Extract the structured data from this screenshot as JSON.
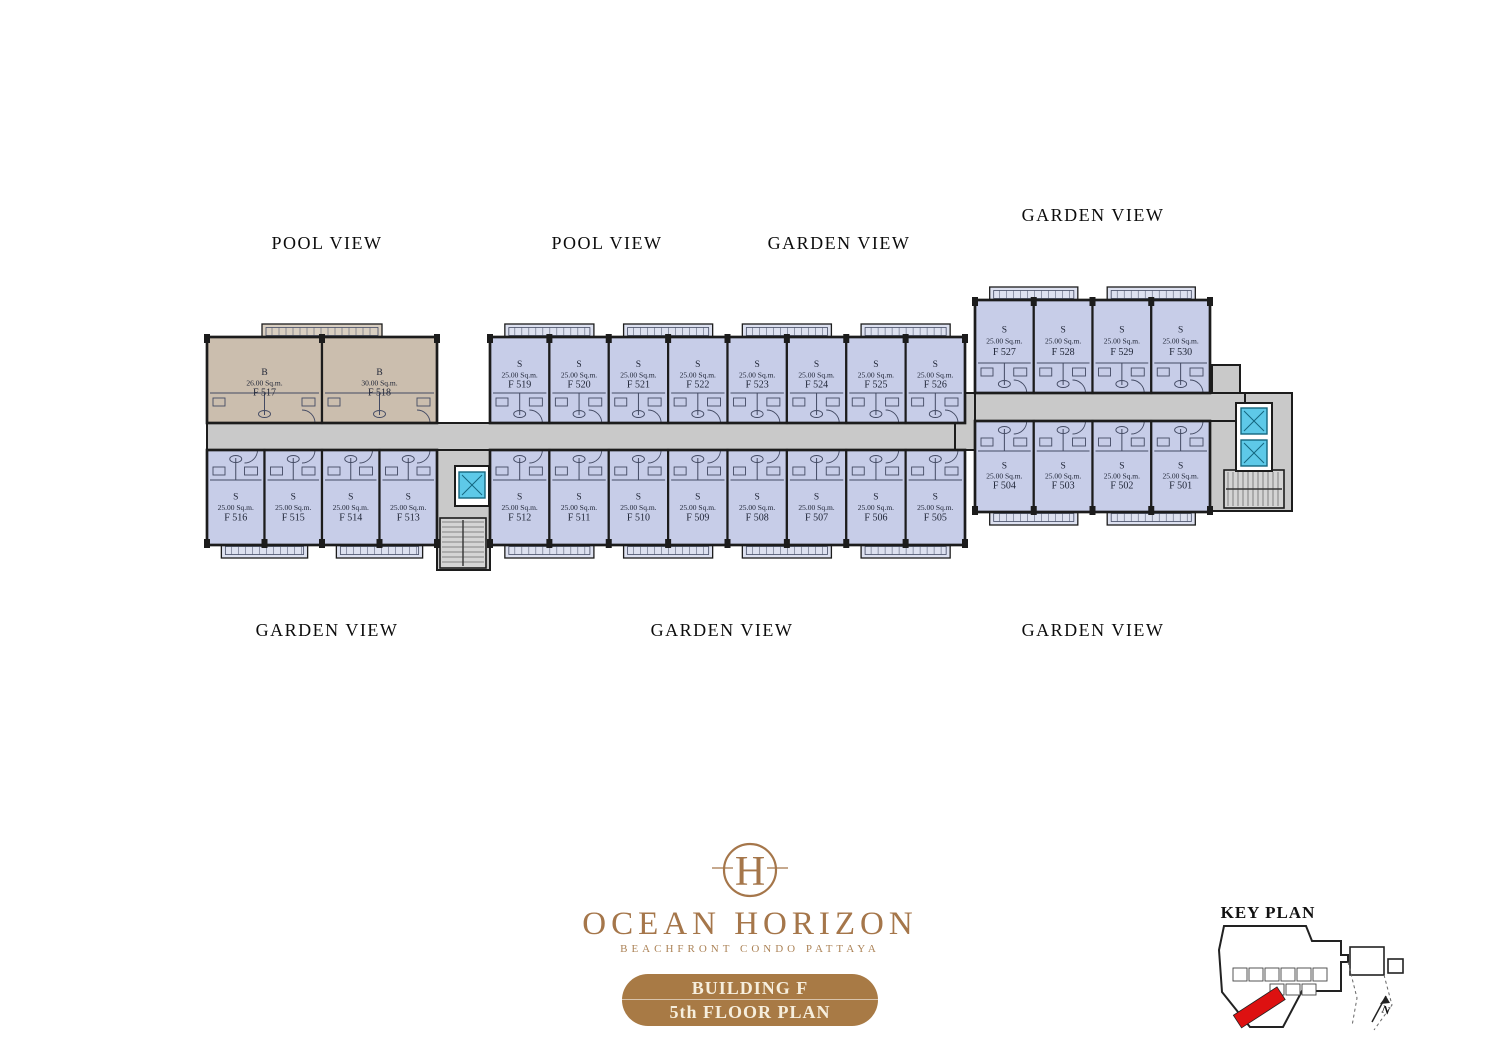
{
  "colors": {
    "unit_fill": "#c7cde8",
    "unit_fill_b": "#cbbeae",
    "wall": "#1c1c1c",
    "interior_line": "#434a63",
    "corridor_fill": "#c9c9c9",
    "balcony_fill": "#dde1f0",
    "balcony_fill_b": "#d9cfc1",
    "stair_fill": "#d4d4d4",
    "elevator_fill": "#5ec9e8",
    "elevator_line": "#14677f",
    "text": "#202637",
    "brand": "#a5764a",
    "banner_bg": "#a87a45",
    "banner_text": "#f6eedd",
    "keyplan_red": "#dd1111",
    "label": "#0c0c0c"
  },
  "view_labels": [
    {
      "text": "POOL VIEW"
    },
    {
      "text": "POOL VIEW"
    },
    {
      "text": "GARDEN VIEW"
    },
    {
      "text": "GARDEN VIEW"
    },
    {
      "text": "GARDEN VIEW"
    },
    {
      "text": "GARDEN VIEW"
    },
    {
      "text": "GARDEN VIEW"
    }
  ],
  "plan": {
    "blocks": [
      {
        "id": "block-left-top",
        "x": 207,
        "y": 337,
        "w": 230,
        "h": 86,
        "row": "top",
        "type_fill": "b",
        "labelDy": 8,
        "units": [
          {
            "id": "F 517",
            "type": "B",
            "area": "26.00 Sq.m."
          },
          {
            "id": "F 518",
            "type": "B",
            "area": "30.00 Sq.m."
          }
        ]
      },
      {
        "id": "block-left-bottom",
        "x": 207,
        "y": 450,
        "w": 230,
        "h": 95,
        "row": "bottom",
        "units": [
          {
            "id": "F 516",
            "type": "S",
            "area": "25.00 Sq.m."
          },
          {
            "id": "F 515",
            "type": "S",
            "area": "25.00 Sq.m."
          },
          {
            "id": "F 514",
            "type": "S",
            "area": "25.00 Sq.m."
          },
          {
            "id": "F 513",
            "type": "S",
            "area": "25.00 Sq.m."
          }
        ]
      },
      {
        "id": "block-mid-top",
        "x": 490,
        "y": 337,
        "w": 475,
        "h": 86,
        "row": "top",
        "units": [
          {
            "id": "F 519",
            "type": "S",
            "area": "25.00 Sq.m."
          },
          {
            "id": "F 520",
            "type": "S",
            "area": "25.00 Sq.m."
          },
          {
            "id": "F 521",
            "type": "S",
            "area": "25.00 Sq.m."
          },
          {
            "id": "F 522",
            "type": "S",
            "area": "25.00 Sq.m."
          },
          {
            "id": "F 523",
            "type": "S",
            "area": "25.00 Sq.m."
          },
          {
            "id": "F 524",
            "type": "S",
            "area": "25.00 Sq.m."
          },
          {
            "id": "F 525",
            "type": "S",
            "area": "25.00 Sq.m."
          },
          {
            "id": "F 526",
            "type": "S",
            "area": "25.00 Sq.m."
          }
        ]
      },
      {
        "id": "block-mid-bottom",
        "x": 490,
        "y": 450,
        "w": 475,
        "h": 95,
        "row": "bottom",
        "units": [
          {
            "id": "F 512",
            "type": "S",
            "area": "25.00 Sq.m."
          },
          {
            "id": "F 511",
            "type": "S",
            "area": "25.00 Sq.m."
          },
          {
            "id": "F 510",
            "type": "S",
            "area": "25.00 Sq.m."
          },
          {
            "id": "F 509",
            "type": "S",
            "area": "25.00 Sq.m."
          },
          {
            "id": "F 508",
            "type": "S",
            "area": "25.00 Sq.m."
          },
          {
            "id": "F 507",
            "type": "S",
            "area": "25.00 Sq.m."
          },
          {
            "id": "F 506",
            "type": "S",
            "area": "25.00 Sq.m."
          },
          {
            "id": "F 505",
            "type": "S",
            "area": "25.00 Sq.m."
          }
        ]
      },
      {
        "id": "block-right-top",
        "x": 975,
        "y": 300,
        "w": 235,
        "h": 93,
        "row": "top",
        "units": [
          {
            "id": "F 527",
            "type": "S",
            "area": "25.00 Sq.m."
          },
          {
            "id": "F 528",
            "type": "S",
            "area": "25.00 Sq.m."
          },
          {
            "id": "F 529",
            "type": "S",
            "area": "25.00 Sq.m."
          },
          {
            "id": "F 530",
            "type": "S",
            "area": "25.00 Sq.m."
          }
        ]
      },
      {
        "id": "block-right-bottom",
        "x": 975,
        "y": 421,
        "w": 235,
        "h": 91,
        "row": "bottom",
        "units": [
          {
            "id": "F 504",
            "type": "S",
            "area": "25.00 Sq.m."
          },
          {
            "id": "F 503",
            "type": "S",
            "area": "25.00 Sq.m."
          },
          {
            "id": "F 502",
            "type": "S",
            "area": "25.00 Sq.m."
          },
          {
            "id": "F 501",
            "type": "S",
            "area": "25.00 Sq.m."
          }
        ]
      }
    ],
    "service_areas": [
      {
        "x": 437,
        "y": 450,
        "w": 53,
        "h": 120
      },
      {
        "x": 1210,
        "y": 393,
        "w": 82,
        "h": 118
      },
      {
        "x": 1212,
        "y": 365,
        "w": 28,
        "h": 32
      }
    ],
    "corridors": [
      {
        "x": 207,
        "y": 423,
        "w": 768,
        "h": 27
      },
      {
        "x": 955,
        "y": 393,
        "w": 290,
        "h": 28
      },
      {
        "x": 955,
        "y": 393,
        "w": 20,
        "h": 57
      }
    ],
    "stairs": [
      {
        "x": 440,
        "y": 518,
        "w": 46,
        "h": 50,
        "dir": "h"
      },
      {
        "x": 1224,
        "y": 470,
        "w": 60,
        "h": 38,
        "dir": "v"
      }
    ],
    "elevator_shafts": [
      {
        "x": 455,
        "y": 466,
        "w": 34,
        "h": 40
      },
      {
        "x": 1236,
        "y": 403,
        "w": 36,
        "h": 68
      }
    ],
    "elevators": [
      {
        "x": 459,
        "y": 472,
        "w": 26,
        "h": 26
      },
      {
        "x": 1241,
        "y": 408,
        "w": 26,
        "h": 26
      },
      {
        "x": 1241,
        "y": 440,
        "w": 26,
        "h": 26
      }
    ]
  },
  "logo": {
    "monogram": "H",
    "name": "OCEAN HORIZON",
    "tagline": "BEACHFRONT CONDO PATTAYA",
    "banner_line1": "BUILDING F",
    "banner_line2": "5th FLOOR PLAN"
  },
  "key_plan": {
    "title": "KEY PLAN",
    "north_label": "N"
  }
}
